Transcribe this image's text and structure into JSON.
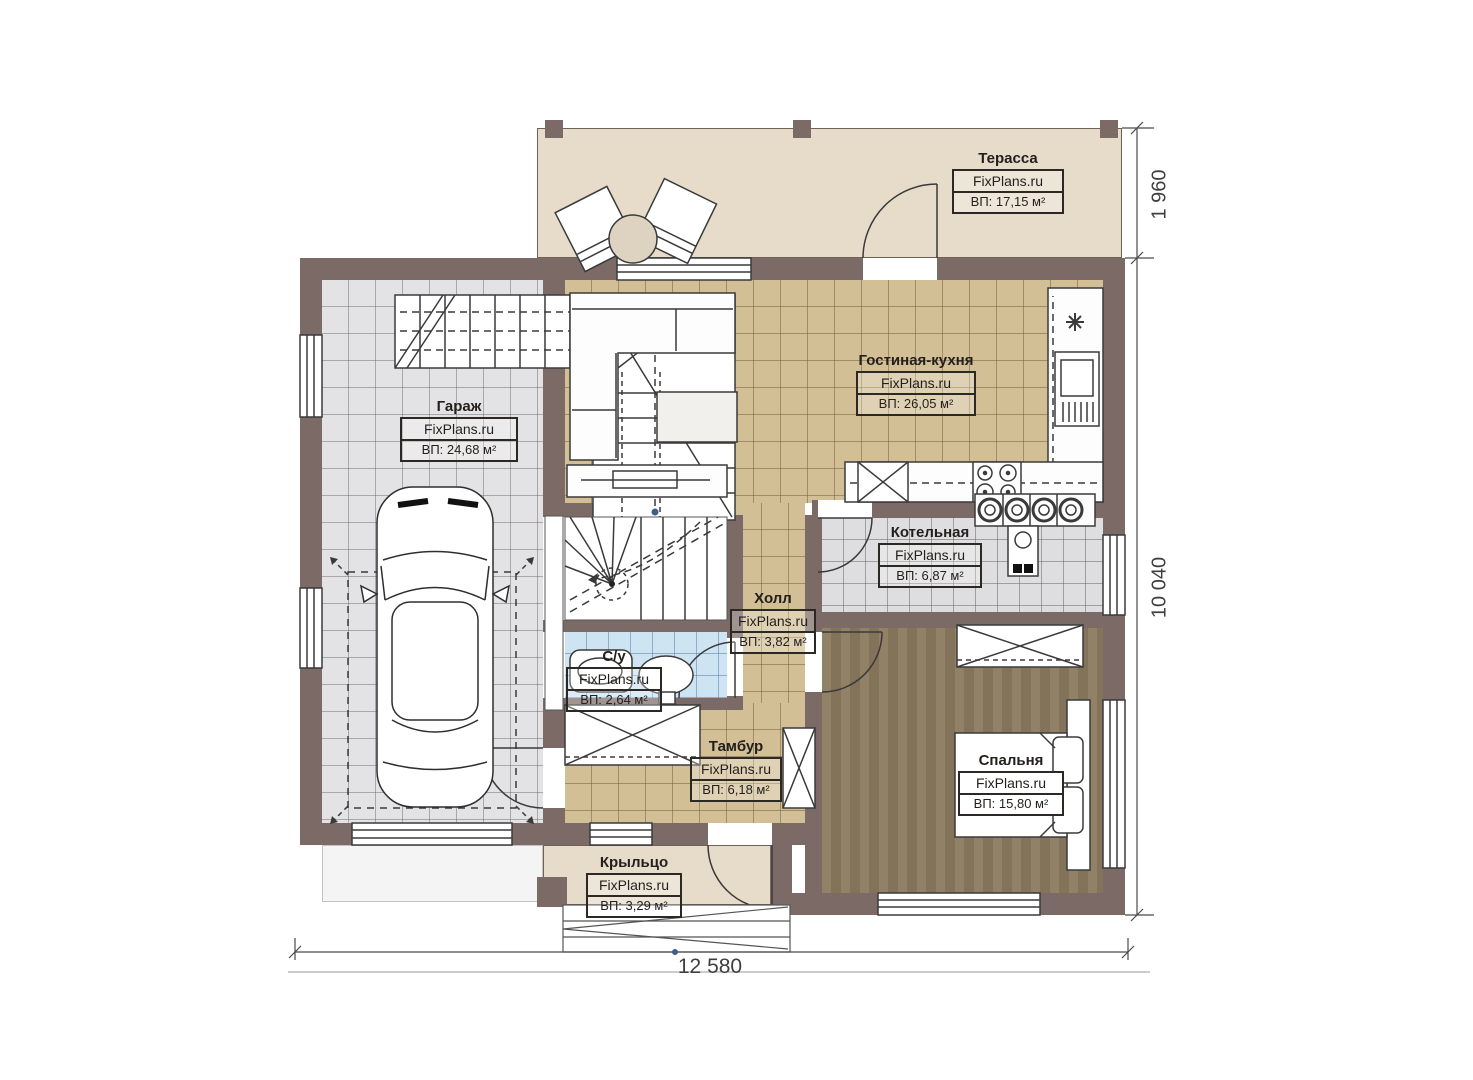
{
  "watermark": "FixPlans.ru",
  "rooms": {
    "terrace": {
      "name": "Терасса",
      "area": "ВП: 17,15 м²"
    },
    "garage": {
      "name": "Гараж",
      "area": "ВП: 24,68 м²"
    },
    "living_kitchen": {
      "name": "Гостиная-кухня",
      "area": "ВП: 26,05 м²"
    },
    "boiler": {
      "name": "Котельная",
      "area": "ВП: 6,87 м²"
    },
    "hall": {
      "name": "Холл",
      "area": "ВП: 3,82 м²"
    },
    "bathroom": {
      "name": "С/у",
      "area": "ВП: 2,64 м²"
    },
    "tambour": {
      "name": "Тамбур",
      "area": "ВП: 6,18 м²"
    },
    "bedroom": {
      "name": "Спальня",
      "area": "ВП: 15,80 м²"
    },
    "porch": {
      "name": "Крыльцо",
      "area": "ВП: 3,29 м²"
    }
  },
  "dimensions": {
    "terrace_depth": "1 960",
    "house_depth": "10 040",
    "house_width": "12 580"
  },
  "colors": {
    "wall": "#7c6a66",
    "floor_tan": "#d3bf96",
    "floor_gray": "#e3e3e5",
    "floor_blue": "#cfe4f3",
    "floor_brown": "#8b7a5f",
    "floor_beige": "#e7dcc9"
  }
}
